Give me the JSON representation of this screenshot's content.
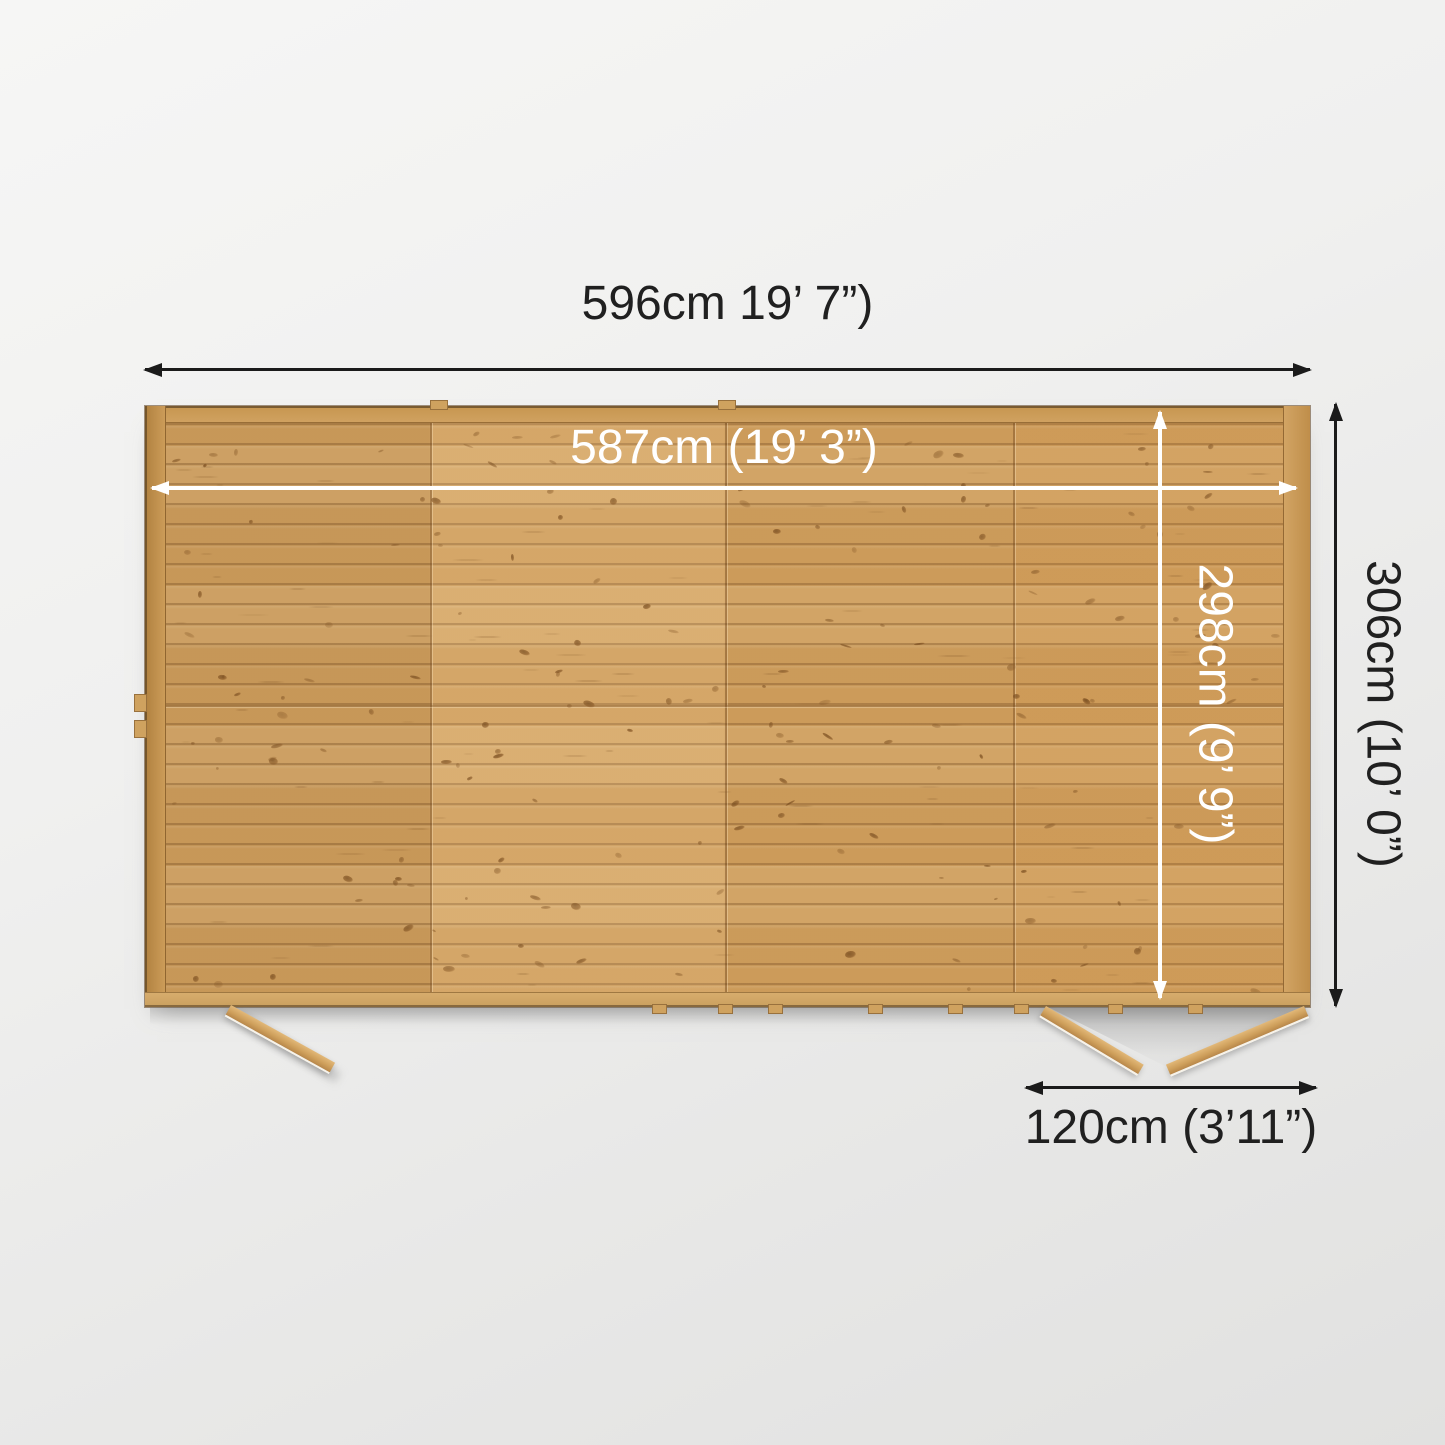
{
  "diagram": {
    "dimensions": {
      "outer_width": {
        "label": "596cm 19’ 7”)"
      },
      "inner_width": {
        "label": "587cm (19’ 3”)"
      },
      "inner_depth": {
        "label": "298cm (9’ 9”)"
      },
      "outer_depth": {
        "label": "306cm (10’ 0”)"
      },
      "door_opening_width": {
        "label": "120cm (3’11”)"
      }
    },
    "annotation_colors": {
      "outer_arrows": "#1b1b1b",
      "inner_arrows": "#ffffff"
    },
    "wood_color": "#d2a15f",
    "background_color": "#efefee"
  }
}
